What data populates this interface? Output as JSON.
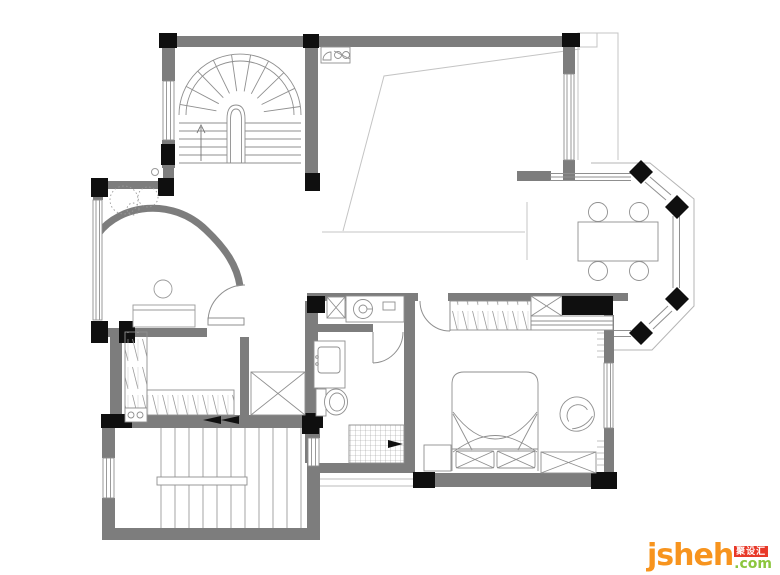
{
  "meta": {
    "drawing": "residential upper floor plan, CAD style, white background"
  },
  "palette": {
    "paper": "#ffffff",
    "wall_gray": "#7d7d7d",
    "column_black": "#0f0f0f",
    "furniture_line": "#8f8f8f",
    "light_line": "#c4c4c4",
    "logo_orange": "#f7941e",
    "logo_green": "#8cc63e",
    "logo_red": "#e83828"
  },
  "watermark": {
    "brand": "jsheh",
    "badge": "聚设汇",
    "tld": ".com"
  },
  "rooms": [
    {
      "name": "curved-staircase-hall",
      "position": "top-left"
    },
    {
      "name": "double-height-void",
      "position": "top-center"
    },
    {
      "name": "dining-room-with-bay-window",
      "position": "right"
    },
    {
      "name": "foyer-with-curved-wall",
      "position": "middle-left"
    },
    {
      "name": "walk-in-closet",
      "position": "left"
    },
    {
      "name": "bathroom",
      "position": "center-bottom"
    },
    {
      "name": "bedroom",
      "position": "bottom-right"
    },
    {
      "name": "straight-staircase",
      "position": "bottom-left"
    }
  ],
  "furniture": [
    "fan-shaped stair treads",
    "arched niche",
    "up arrow",
    "dining table",
    "four round chairs",
    "black sideboard",
    "bed with two pillows",
    "left nightstand",
    "bench with X front",
    "tub chair",
    "hanging-clothes wardrobes",
    "shaft with X cross",
    "vanity with sink",
    "round wash basin counter",
    "toilet",
    "gridded shower floor",
    "desk",
    "round stool",
    "shrub plant",
    "straight stair flight with center handrail"
  ]
}
